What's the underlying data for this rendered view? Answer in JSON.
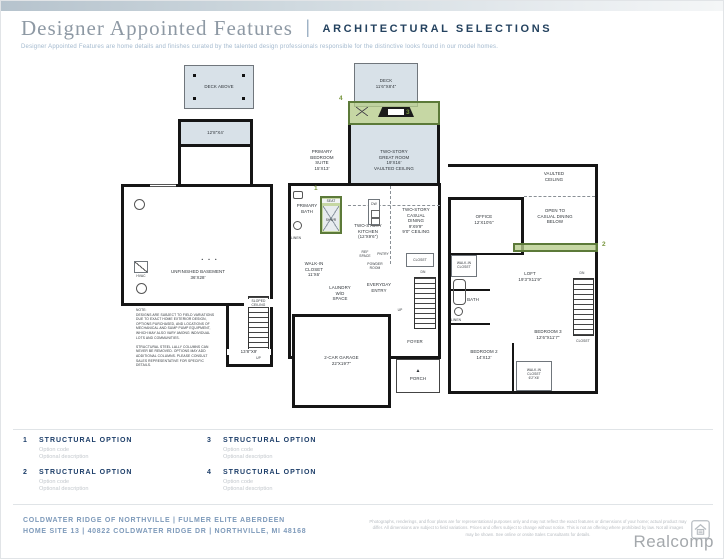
{
  "header": {
    "title_serif": "Designer Appointed Features",
    "title_divider": "|",
    "title_caps": "ARCHITECTURAL SELECTIONS",
    "subtitle": "Designer Appointed Features are home details and finishes curated by the talented design professionals responsible for the distinctive looks found in our model homes."
  },
  "markers": {
    "one": "1",
    "two": "2",
    "three": "3",
    "four": "4"
  },
  "plans": {
    "basement": {
      "deck_above": "DECK ABOVE",
      "under_deck_dim": "12'8\"X4'",
      "room": "UNFINISHED BASEMENT\n36'X28'",
      "columns_dots": "• • •",
      "hvac": "HVAC",
      "sloped_ceiling": "SLOPED\nCEILING",
      "up": "UP",
      "stair_dim": "13'8\"X9'",
      "note": "NOTE:\nDESIGNS ARE SUBJECT TO FIELD VARIATIONS\nDUE TO EXACT HOME EXTERIOR DESIGN,\nOPTIONS PURCHASED, AND LOCATIONS OF\nMECHANICAL AND SUMP PUMP EQUIPMENT,\nWHICH MAY ALSO VARY AMONG INDIVIDUAL\nLOTS AND COMMUNITIES.\n\nSTRUCTURAL STEEL LALLY COLUMNS CAN\nNEVER BE REMOVED. OPTIONS MAY ADD\nADDITIONAL COLUMNS. PLEASE CONSULT\nSALES REPRESENTATIVE FOR SPECIFIC\nDETAILS."
    },
    "main_floor": {
      "deck": "DECK\n11'6\"X8'4\"",
      "great_room": "TWO-STORY\nGREAT ROOM\n19'X16'\nVAULTED CEILING",
      "primary_suite": "PRIMARY\nBEDROOM\nSUITE\n15'X13'",
      "seat": "SEAT",
      "shwr": "SHWR",
      "primary_bath": "PRIMARY\nBATH",
      "linen": "LINEN",
      "kitchen": "TWO-STORY\nKITCHEN\n(12'X9'6\")",
      "dw": "DW",
      "casual_dining": "TWO-STORY\nCASUAL\nDINING\n9'X9'9\"\n9'0\" CEILING",
      "ref_space": "REF\nSPACE",
      "pntry": "PNTRY",
      "powder": "POWDER\nROOM",
      "closet": "CLOSET",
      "walk_in": "WALK-IN\nCLOSET\n11'X6'",
      "laundry": "LAUNDRY\nW/D\nSPACE",
      "everyday": "EVERYDAY\nENTRY",
      "dn": "DN",
      "up": "UP",
      "steps_note": "STEPS FROM HOME TO GARAGE/\nPORCH/PATIO MAY VARY DUE\nTO SITE CONDITIONS",
      "garage": "2-CAR GARAGE\n22'X19'7\"",
      "foyer": "FOYER",
      "entry_arrow": "▲",
      "porch": "PORCH"
    },
    "second_floor": {
      "vaulted": "VAULTED\nCEILING",
      "office": "OFFICE\n12'X10'6\"",
      "open_below": "OPEN TO\nCASUAL DINING\nBELOW",
      "walk_in_small": "WALK-IN\nCLOSET",
      "loft": "LOFT\n19'3\"X11'9\"",
      "dn": "DN",
      "bath": "BATH",
      "linen": "LINEN",
      "bedroom3": "BEDROOM 3\n12'6\"X11'7\"",
      "closet": "CLOSET",
      "bedroom2": "BEDROOM 2\n14'X12'",
      "walk_in2": "WALK-IN\nCLOSET\n6'2\"X6'"
    }
  },
  "legend": {
    "items": [
      {
        "num": "1",
        "title": "STRUCTURAL OPTION",
        "sub": "Option code\nOptional description"
      },
      {
        "num": "2",
        "title": "STRUCTURAL OPTION",
        "sub": "Option code\nOptional description"
      },
      {
        "num": "3",
        "title": "STRUCTURAL OPTION",
        "sub": "Option code\nOptional description"
      },
      {
        "num": "4",
        "title": "STRUCTURAL OPTION",
        "sub": "Option code\nOptional description"
      }
    ]
  },
  "footer": {
    "left_lines": "COLDWATER RIDGE OF NORTHVILLE | FULMER ELITE ABERDEEN\nHOME SITE 13 | 40822 COLDWATER RIDGE DR | NORTHVILLE, MI 48168",
    "disclaimer": "Photographs, renderings, and floor plans are for representational purposes only and may not reflect the exact features or dimensions of your home; actual product may differ. All dimensions are subject to field variations. Prices and offers subject to change without notice. This is not an offering where prohibited by law. Not all images may be shown. See online or onsite Sales Consultants for details.",
    "brand": "Realcomp"
  }
}
